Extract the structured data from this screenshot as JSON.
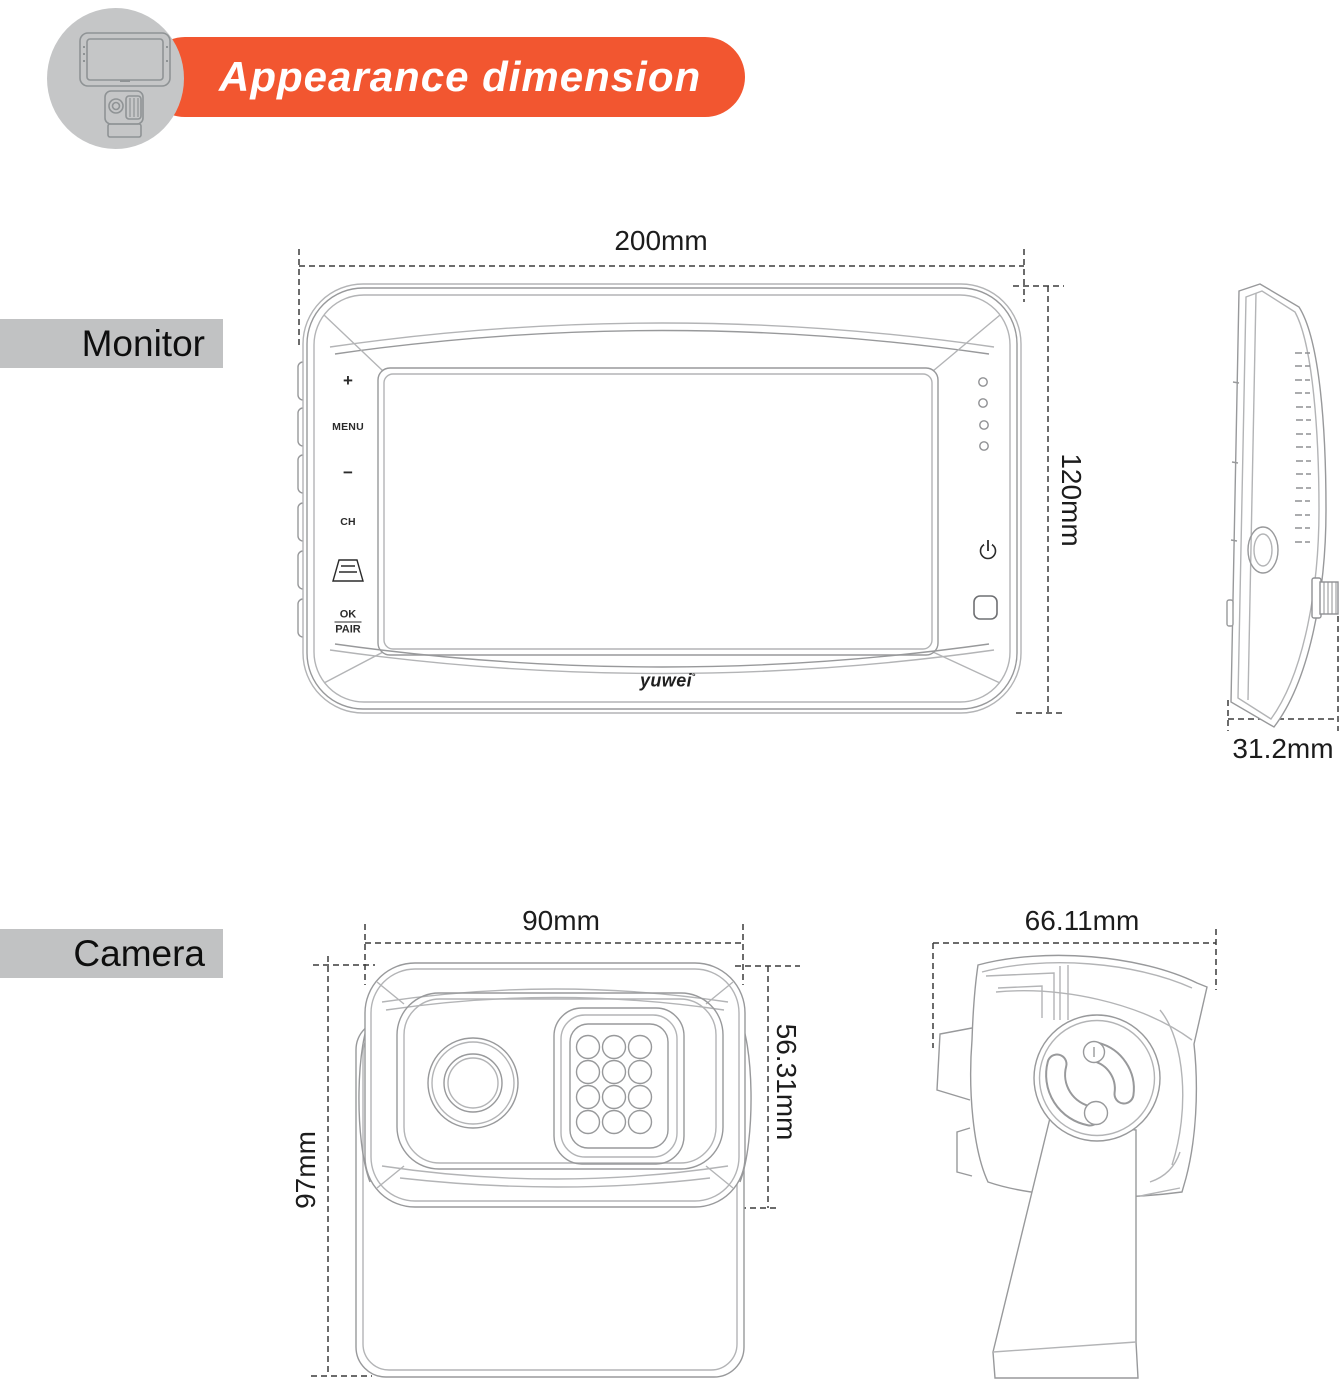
{
  "header": {
    "title": "Appearance dimension",
    "accent_color": "#F25630",
    "badge_color": "#c5c6c7"
  },
  "sections": {
    "monitor_label": "Monitor",
    "camera_label": "Camera",
    "bar_color": "#c1c2c3"
  },
  "monitor": {
    "front": {
      "width_label": "200mm",
      "height_label": "120mm",
      "buttons": {
        "plus": "+",
        "menu": "MENU",
        "minus": "−",
        "ch": "CH",
        "ok": "OK",
        "pair": "PAIR"
      },
      "logo": "yuwei",
      "logo_mark": "°"
    },
    "side": {
      "depth_label": "31.2mm"
    }
  },
  "camera": {
    "front": {
      "width_label": "90mm",
      "height_label": "97mm",
      "body_height_label": "56.31mm"
    },
    "side": {
      "width_label": "66.11mm"
    }
  }
}
